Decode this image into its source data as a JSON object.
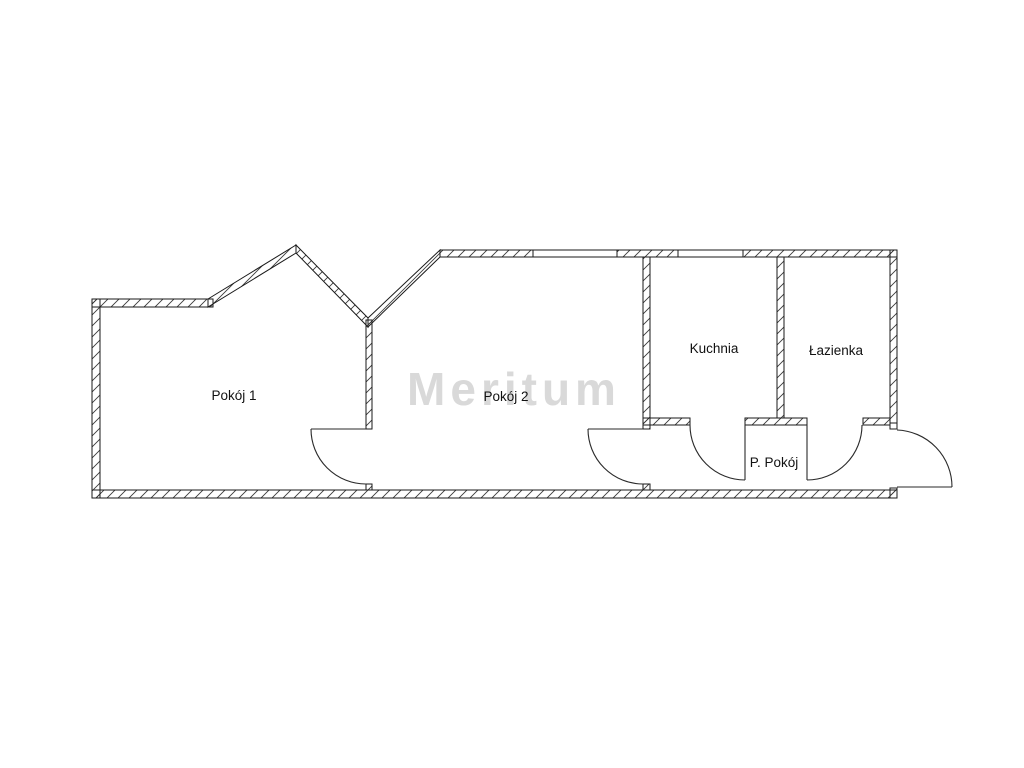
{
  "diagram": {
    "type": "floor-plan",
    "watermark": "Meritum",
    "rooms": [
      {
        "id": "pokoj-1",
        "label": "Pokój 1"
      },
      {
        "id": "pokoj-2",
        "label": "Pokój 2"
      },
      {
        "id": "kuchnia",
        "label": "Kuchnia"
      },
      {
        "id": "lazienka",
        "label": "Łazienka"
      },
      {
        "id": "p-pokoj",
        "label": "P. Pokój"
      }
    ],
    "counts": {
      "windows_visible": "2",
      "door_swings_visible": "5"
    },
    "colors": {
      "background": "#ffffff",
      "wall_line": "#1a1a1a",
      "watermark": "#d9d9d9"
    }
  }
}
